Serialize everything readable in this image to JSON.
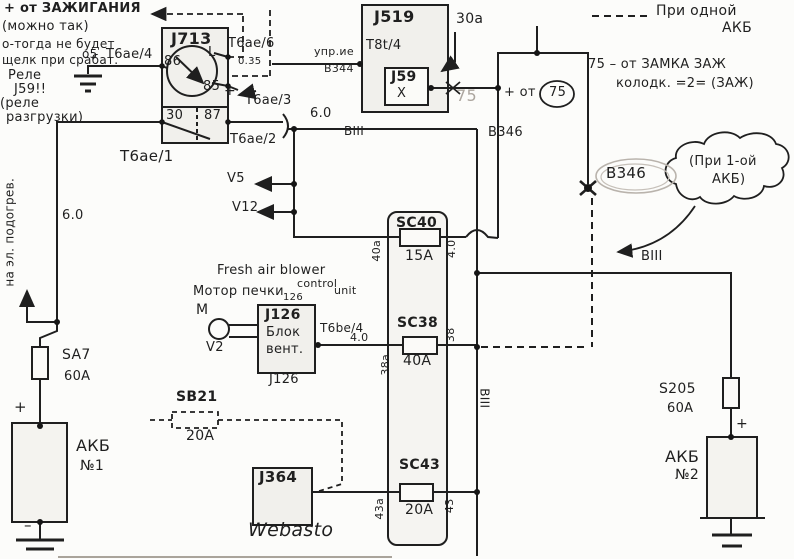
{
  "colors": {
    "ink": "#1f1f1f",
    "pencil_gray": "#aca69f",
    "box_fill": "#f1f0ec",
    "paper": "#fcfcfa"
  },
  "notes": {
    "ignition_line1": "+ от ЗАЖИГАНИЯ",
    "ignition_line2": "(можно так)",
    "ignition_line3": "о-тогда не будет",
    "ignition_line4": "щелк при срабат.",
    "ignition_line5": "Реле",
    "ignition_line6": "J59!!",
    "ignition_line7": "(реле",
    "ignition_line8": "разгрузки)",
    "one_battery_legend_1": "При одной",
    "one_battery_legend_2": "АКБ",
    "term75_note_1": "75 – от ЗАМКА ЗАЖ",
    "term75_note_2": "колодк. =2= (ЗАЖ)",
    "cloud_line1": "(При 1-ой",
    "cloud_line2": "АКБ)",
    "heater_feed": "на эл. подогрев.",
    "fresh_air_1": "Fresh air blower",
    "fresh_air_2": "control",
    "fresh_air_3": "unit",
    "motor_pechki": "Мотор печки"
  },
  "relay_j713": {
    "title": "J713",
    "t86": "86",
    "tL": "L",
    "t85": "85",
    "t30": "30",
    "t87": "87",
    "conn1": "Т6ае/1",
    "conn2": "Т6ае/2",
    "conn3": "Т6ае/3",
    "conn4": "Т6ае/4",
    "conn6": "Т6ае/6",
    "gauge_035": "0.35",
    "ground_pt": "о5",
    "plus": "+"
  },
  "bcm_j519": {
    "title": "J519",
    "connector": "Т8t/4",
    "relay": "J59",
    "x": "X",
    "wire_upr": "упр.ие",
    "wire_v344": "В344",
    "in_30a": "30а",
    "out_75": "75",
    "plus_ot": "+ от",
    "circled_75": "75",
    "wire_v346": "В346",
    "v346_tag": "В346"
  },
  "wires": {
    "g6_left": "6.0",
    "g6_mid": "6.0",
    "viii_mid": "ВIII",
    "viii_right": "ВIII",
    "viii_rot": "ВIII",
    "v5": "V5",
    "v12": "V12",
    "g4": "4.0"
  },
  "fusebox": {
    "sc40": {
      "name": "SC40",
      "amps": "15А",
      "left": "40а",
      "right": "4.0"
    },
    "sc38": {
      "name": "SC38",
      "amps": "40А",
      "left": "38а",
      "right": "38"
    },
    "sc43": {
      "name": "SC43",
      "amps": "20А",
      "left": "43а",
      "right": "43"
    }
  },
  "sb21": {
    "name": "SB21",
    "amps": "20А"
  },
  "j364": {
    "name": "J364",
    "caption": "Webasto"
  },
  "j126": {
    "above": "126",
    "name": "J126",
    "line2": "Блок",
    "line3": "вент.",
    "below": "J126",
    "motor_m": "М",
    "motor_v2": "V2",
    "out_conn": "Т6bе/4"
  },
  "battery1": {
    "fuse": "SA7",
    "fuse_amps": "60А",
    "name": "АКБ",
    "num": "№1",
    "plus": "+",
    "minus": "–"
  },
  "battery2": {
    "fuse": "S205",
    "fuse_amps": "60А",
    "name": "АКБ",
    "num": "№2",
    "plus": "+"
  }
}
